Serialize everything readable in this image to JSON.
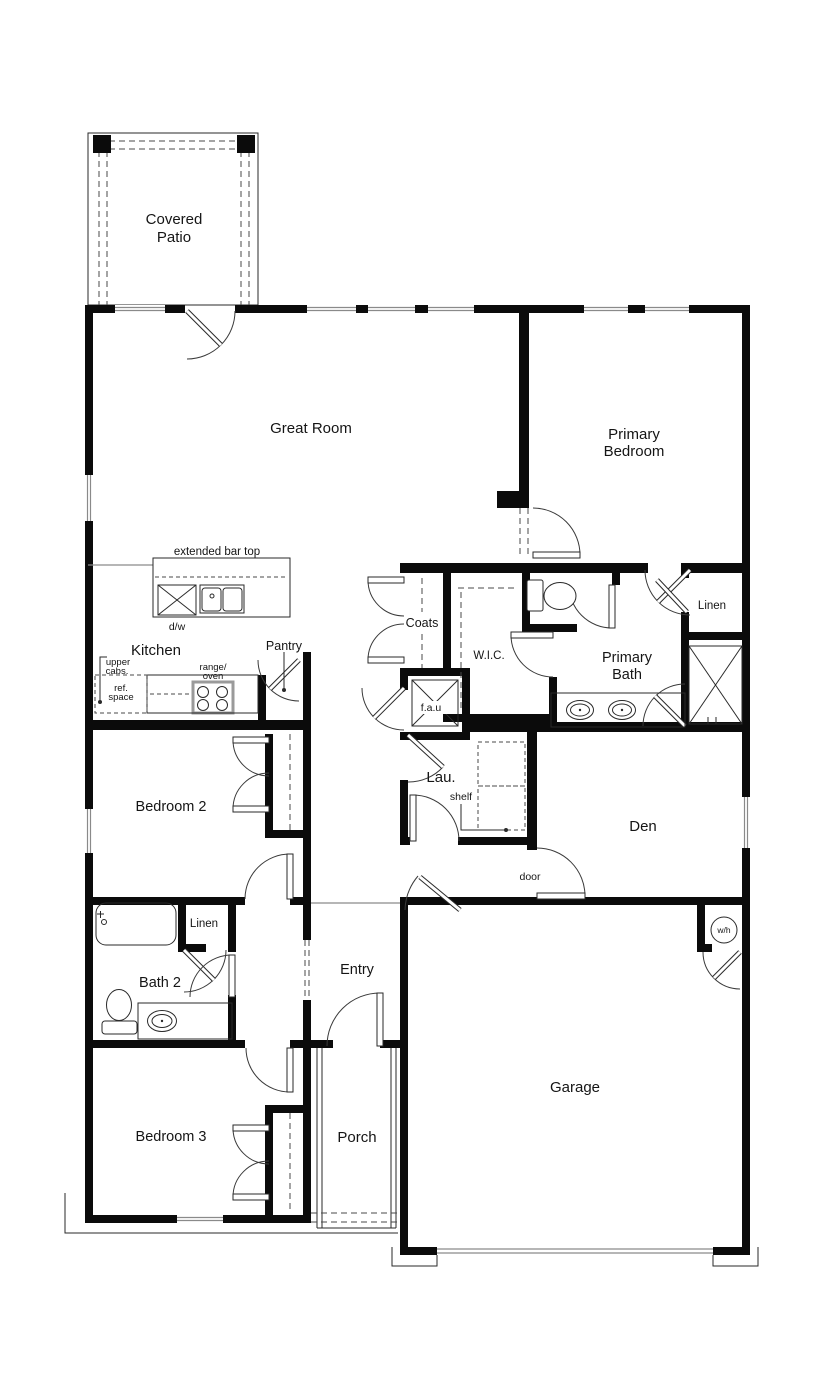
{
  "plan": {
    "title": "single-story floor plan",
    "labels": {
      "covered_patio_1": "Covered",
      "covered_patio_2": "Patio",
      "great_room": "Great Room",
      "primary_bedroom_1": "Primary",
      "primary_bedroom_2": "Bedroom",
      "extended_bar_top": "extended bar top",
      "dishwasher": "d/w",
      "kitchen": "Kitchen",
      "pantry": "Pantry",
      "upper_cabs_1": "upper",
      "upper_cabs_2": "cabs.",
      "ref_space_1": "ref.",
      "ref_space_2": "space",
      "range_oven_1": "range/",
      "range_oven_2": "oven",
      "coats": "Coats",
      "wic": "W.I.C.",
      "primary_bath_1": "Primary",
      "primary_bath_2": "Bath",
      "linen_primary": "Linen",
      "fau": "f.a.u",
      "laundry": "Lau.",
      "shelf": "shelf",
      "den": "Den",
      "door": "door",
      "bedroom2": "Bedroom 2",
      "linen_hall": "Linen",
      "bath2": "Bath 2",
      "entry": "Entry",
      "bedroom3": "Bedroom 3",
      "porch": "Porch",
      "garage": "Garage",
      "water_heater": "w/h"
    },
    "colors": {
      "walls": "#0b0b0b",
      "thin_lines": "#2a2a2a",
      "window_lines": "#8a8a8a",
      "background": "#ffffff"
    }
  }
}
